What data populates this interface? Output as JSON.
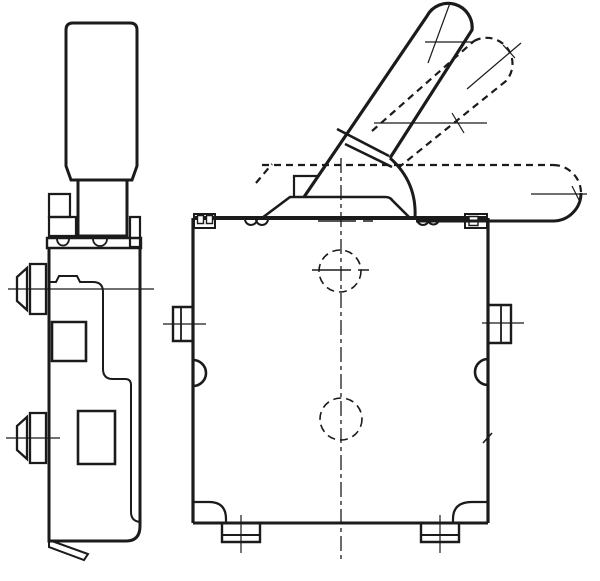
{
  "drawing": {
    "type": "technical-line-drawing",
    "subject": "toggle-switch-orthographic-views",
    "background_color": "#ffffff",
    "line_color": "#1b1b1b",
    "views": {
      "left": "side-view",
      "right": "front-view-with-three-lever-positions"
    },
    "lever_positions": [
      "up-solid",
      "mid-phantom-dashed",
      "horizontal-phantom"
    ]
  }
}
